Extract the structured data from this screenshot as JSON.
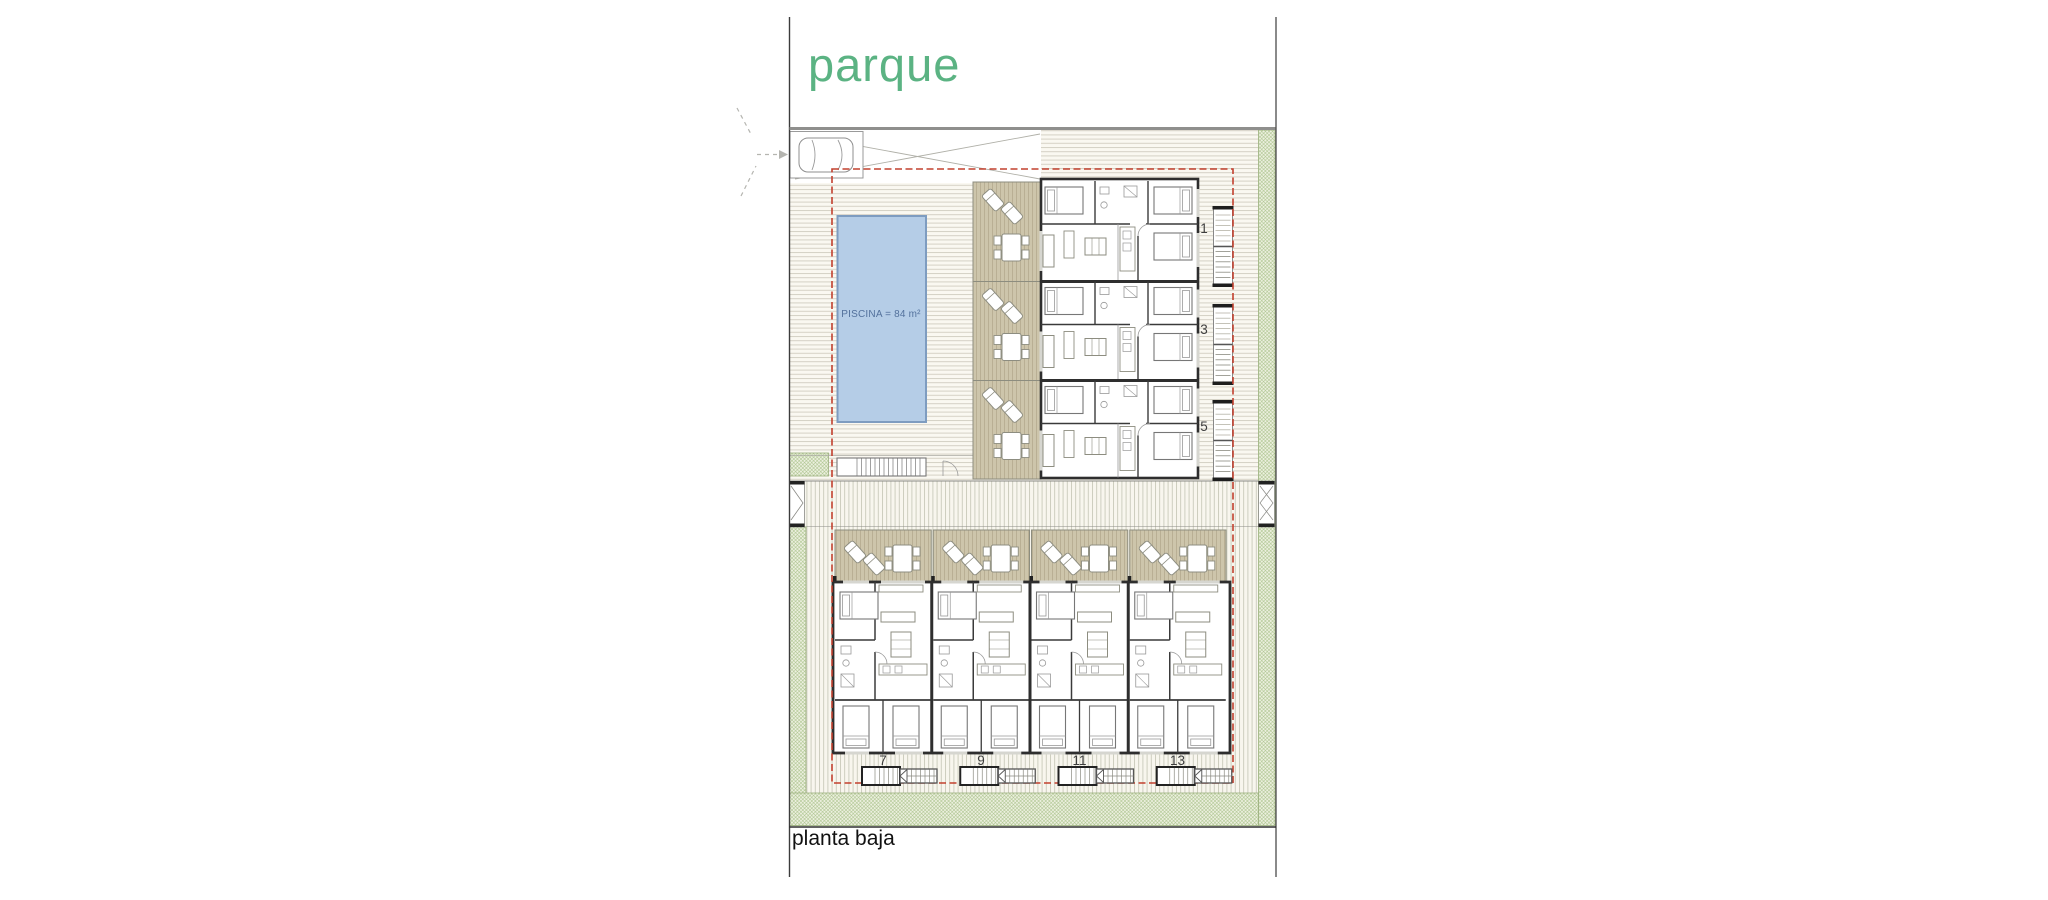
{
  "labels": {
    "park": "parque",
    "floor": "planta baja"
  },
  "pool": {
    "label": "PISCINA = 84 m²",
    "area_m2": 84
  },
  "upper_units": [
    {
      "number": "1"
    },
    {
      "number": "3"
    },
    {
      "number": "5"
    }
  ],
  "lower_units": [
    {
      "number": "7"
    },
    {
      "number": "9"
    },
    {
      "number": "11"
    },
    {
      "number": "13"
    }
  ],
  "colors": {
    "park_text": "#5bb383",
    "pool_fill": "#b5cde7",
    "pool_stroke": "#7e9cc0",
    "pool_label": "#53719c",
    "terrace_fill": "#cdc5ab",
    "green_hatch_line": "#a6c086",
    "boundary_dash": "#c2402e",
    "wall": "#2e2e2e"
  }
}
